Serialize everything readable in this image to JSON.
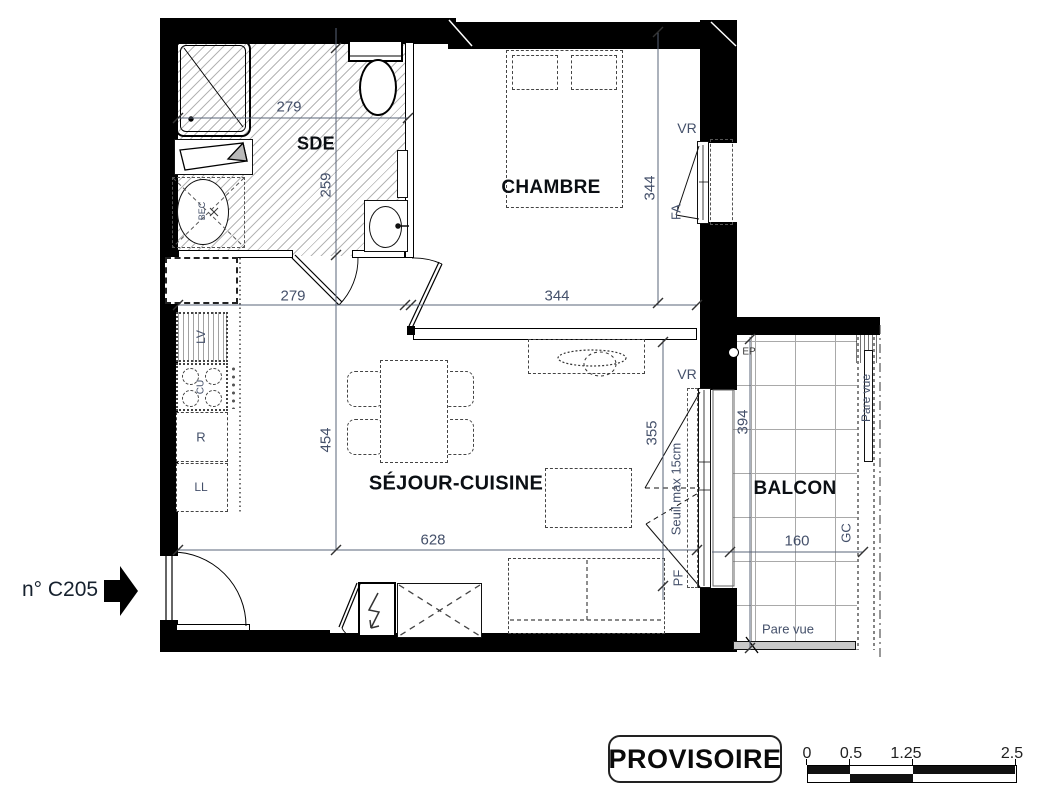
{
  "unit": {
    "label": "n° C205"
  },
  "rooms": {
    "sde": "SDE",
    "chambre": "CHAMBRE",
    "sejour": "SÉJOUR-CUISINE",
    "balcon": "BALCON"
  },
  "dims": {
    "sde_top": "279",
    "sde_h": "259",
    "sde_w": "279",
    "ch_w": "344",
    "ch_h": "344",
    "sej_h": "454",
    "sej_w": "628",
    "win_h": "355",
    "bal_h": "394",
    "bal_w": "160"
  },
  "equip": {
    "lv": "LV",
    "cu": "CU",
    "fridge": "R",
    "ll": "LL",
    "bec": "BEC"
  },
  "win": {
    "vr_ch": "VR",
    "fa": "FA",
    "vr_sej": "VR",
    "pf": "PF",
    "gc": "GC",
    "ep": "EP",
    "seuil": "Seuil max 15cm",
    "pare_vue_side": "Pare vue",
    "pare_vue_bottom": "Pare vue"
  },
  "stamp": {
    "label": "PROVISOIRE"
  },
  "scale": {
    "t0": "0",
    "t1": "0.5",
    "t2": "1.25",
    "t3": "2.5"
  }
}
